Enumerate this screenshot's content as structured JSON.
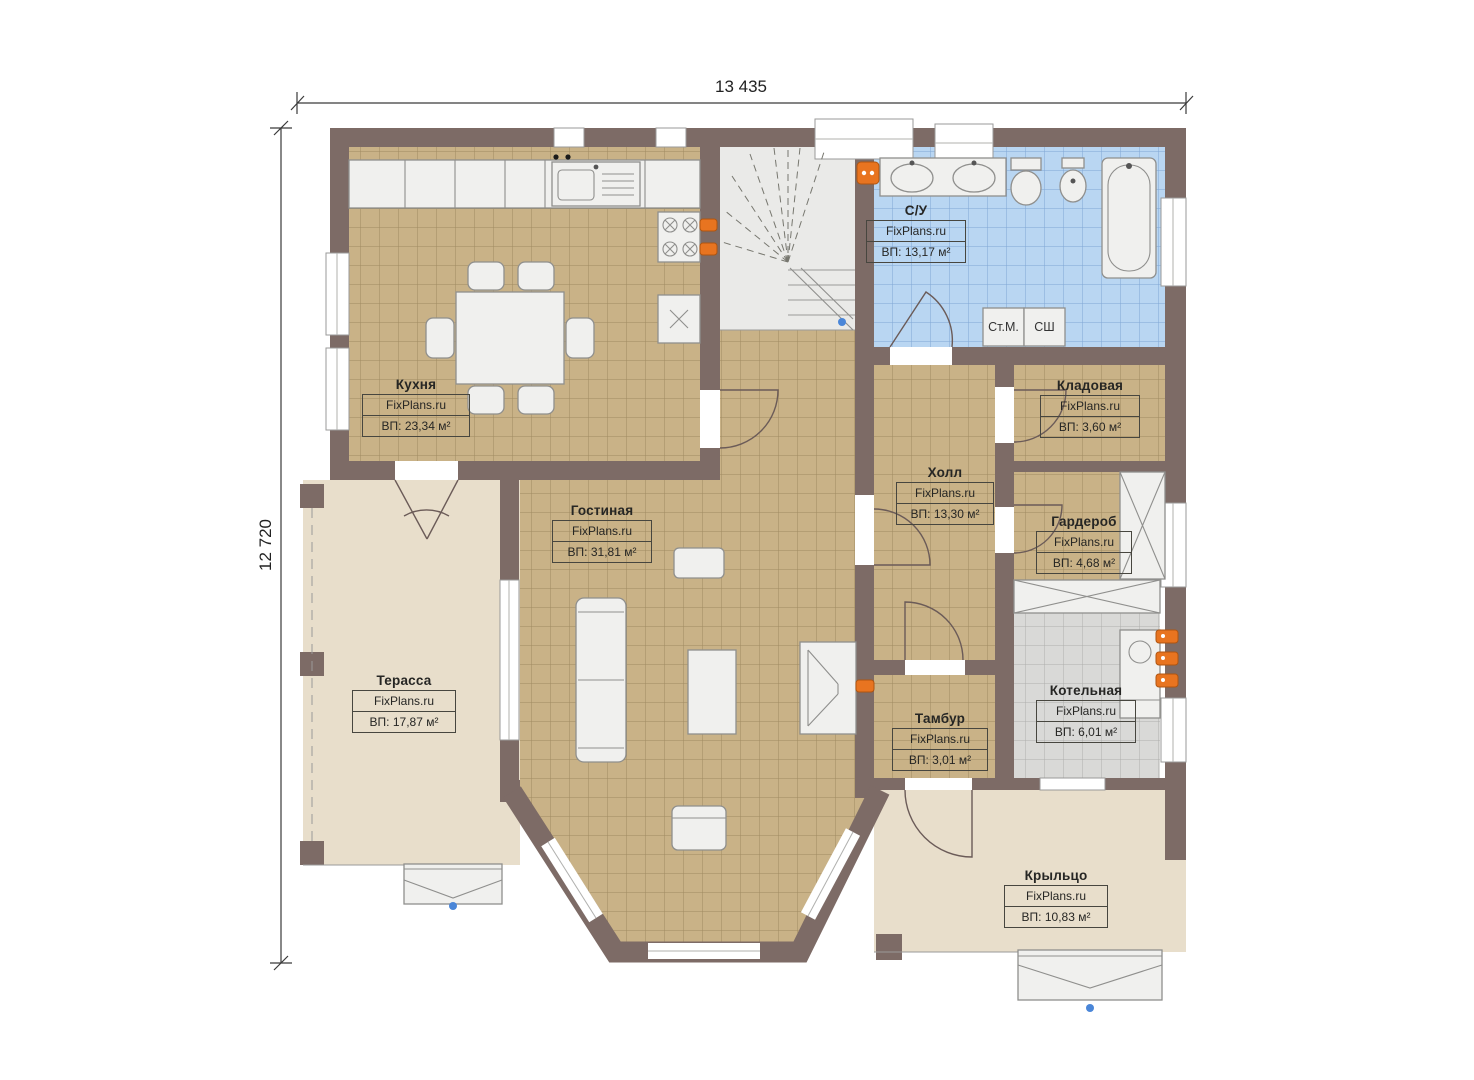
{
  "plan": {
    "watermark": "FixPlans.ru",
    "dimensions": {
      "width_label": "13 435",
      "height_label": "12 720"
    },
    "rooms": {
      "kitchen": {
        "name": "Кухня",
        "area": "ВП: 23,34 м²"
      },
      "bathroom": {
        "name": "С/У",
        "area": "ВП: 13,17 м²"
      },
      "storage": {
        "name": "Кладовая",
        "area": "ВП: 3,60 м²"
      },
      "hall": {
        "name": "Холл",
        "area": "ВП: 13,30 м²"
      },
      "wardrobe": {
        "name": "Гардероб",
        "area": "ВП: 4,68 м²"
      },
      "living": {
        "name": "Гостиная",
        "area": "ВП: 31,81 м²"
      },
      "terrace": {
        "name": "Терасса",
        "area": "ВП: 17,87 м²"
      },
      "vestibule": {
        "name": "Тамбур",
        "area": "ВП: 3,01 м²"
      },
      "boiler": {
        "name": "Котельная",
        "area": "ВП: 6,01 м²"
      },
      "porch": {
        "name": "Крыльцо",
        "area": "ВП: 10,83 м²"
      }
    },
    "appliances": {
      "washing_machine": "Ст.М.",
      "dryer": "СШ"
    },
    "colors": {
      "wall": "#7d6b66",
      "floor_tile": "#c9b287",
      "bathroom_tile": "#b9d6f2",
      "boiler_tile": "#d9d9d7",
      "outdoor_floor": "#e8decb",
      "fixture": "#f0f0ee",
      "radiator": "#e87420"
    }
  }
}
